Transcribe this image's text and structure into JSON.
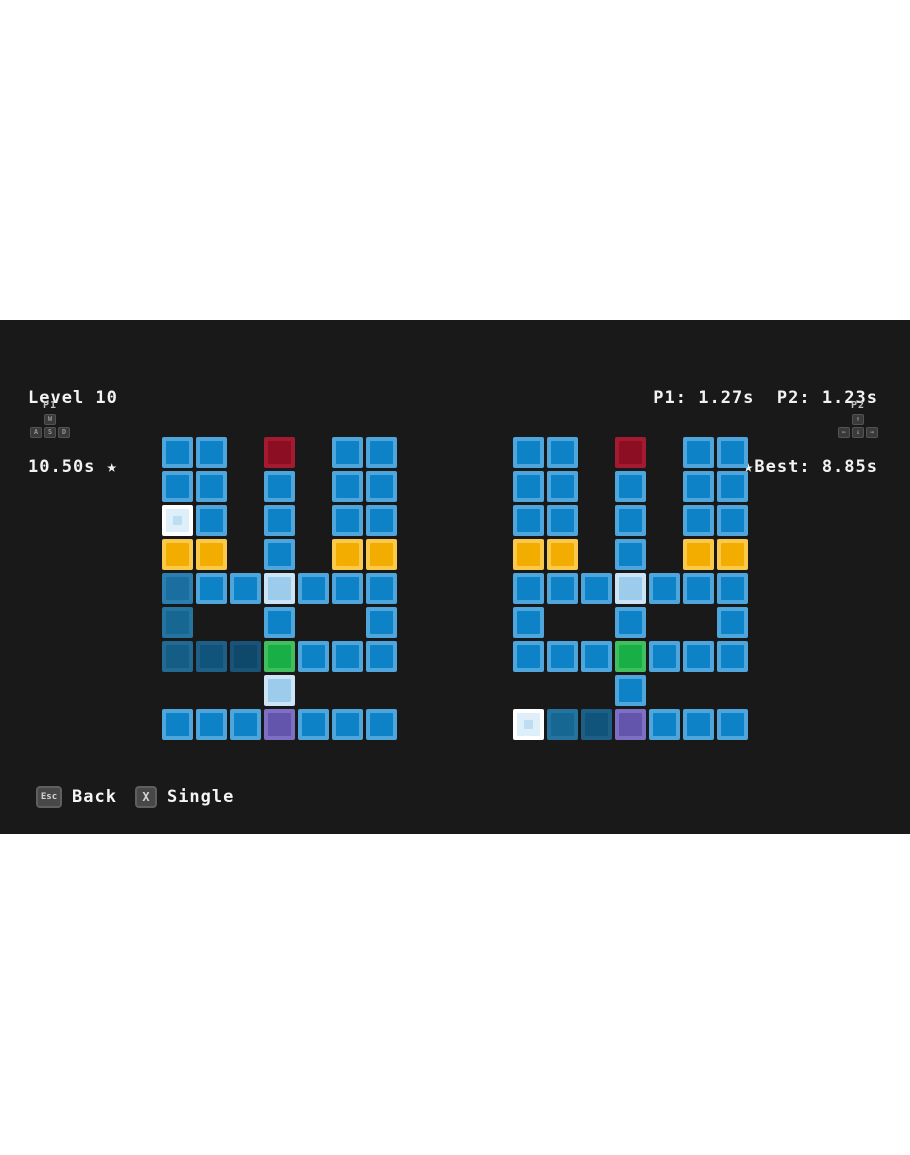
{
  "hud": {
    "level_label": "Level 10",
    "level_best_line": "10.50s ★",
    "player_times": "P1: 1.27s  P2: 1.23s",
    "best_line": "★Best: 8.85s"
  },
  "players": {
    "p1": {
      "label": "P1",
      "keys": [
        "W",
        "A",
        "S",
        "D"
      ]
    },
    "p2": {
      "label": "P2",
      "keys": [
        "↑",
        "←",
        "↓",
        "→"
      ]
    }
  },
  "footer": {
    "back_key": "Esc",
    "back_label": "Back",
    "single_key": "X",
    "single_label": "Single"
  },
  "colors": {
    "stage_background": "#191919",
    "hud_text": "#f2f2f2",
    "page_margin": "#ffffff"
  },
  "board": {
    "palette": {
      "B": {
        "name": "tile-blue",
        "border": "#4FA6DC",
        "fill": "#0E82C6"
      },
      "R": {
        "name": "tile-red",
        "border": "#A41A30",
        "fill": "#8C0E23"
      },
      "Y": {
        "name": "tile-yellow",
        "border": "#FBC94A",
        "fill": "#F3AD00"
      },
      "G": {
        "name": "tile-green",
        "border": "#41BE5E",
        "fill": "#18AF46"
      },
      "U": {
        "name": "tile-purple",
        "border": "#7C6FC4",
        "fill": "#6355AC"
      },
      "I": {
        "name": "tile-ice",
        "border": "#CBE4F6",
        "fill": "#9CCBEC"
      },
      "P": {
        "name": "tile-player",
        "border": "#FFFFFF",
        "fill": "#DFEFF9",
        "dot": "#BCDDF2"
      },
      "a": {
        "name": "tile-trail-1",
        "border": "#2B7EB0",
        "fill": "#1B6FA0"
      },
      "b": {
        "name": "tile-trail-2",
        "border": "#27739F",
        "fill": "#176793"
      },
      "c": {
        "name": "tile-trail-3",
        "border": "#226A93",
        "fill": "#145E86"
      },
      "d": {
        "name": "tile-trail-4",
        "border": "#1D5F87",
        "fill": "#11547B"
      },
      "e": {
        "name": "tile-trail-5",
        "border": "#195377",
        "fill": "#0E496C"
      }
    },
    "left": [
      [
        "B",
        "B",
        ".",
        "R",
        ".",
        "B",
        "B"
      ],
      [
        "B",
        "B",
        ".",
        "B",
        ".",
        "B",
        "B"
      ],
      [
        "P",
        "B",
        ".",
        "B",
        ".",
        "B",
        "B"
      ],
      [
        "Y",
        "Y",
        ".",
        "B",
        ".",
        "Y",
        "Y"
      ],
      [
        "a",
        "B",
        "B",
        "I",
        "B",
        "B",
        "B"
      ],
      [
        "b",
        ".",
        ".",
        "B",
        ".",
        ".",
        "B"
      ],
      [
        "c",
        "d",
        "e",
        "G",
        "B",
        "B",
        "B"
      ],
      [
        ".",
        ".",
        ".",
        "I",
        ".",
        ".",
        "."
      ],
      [
        "B",
        "B",
        "B",
        "U",
        "B",
        "B",
        "B"
      ]
    ],
    "right": [
      [
        "B",
        "B",
        ".",
        "R",
        ".",
        "B",
        "B"
      ],
      [
        "B",
        "B",
        ".",
        "B",
        ".",
        "B",
        "B"
      ],
      [
        "B",
        "B",
        ".",
        "B",
        ".",
        "B",
        "B"
      ],
      [
        "Y",
        "Y",
        ".",
        "B",
        ".",
        "Y",
        "Y"
      ],
      [
        "B",
        "B",
        "B",
        "I",
        "B",
        "B",
        "B"
      ],
      [
        "B",
        ".",
        ".",
        "B",
        ".",
        ".",
        "B"
      ],
      [
        "B",
        "B",
        "B",
        "G",
        "B",
        "B",
        "B"
      ],
      [
        ".",
        ".",
        ".",
        "B",
        ".",
        ".",
        "."
      ],
      [
        "P",
        "b",
        "d",
        "U",
        "B",
        "B",
        "B"
      ]
    ]
  }
}
